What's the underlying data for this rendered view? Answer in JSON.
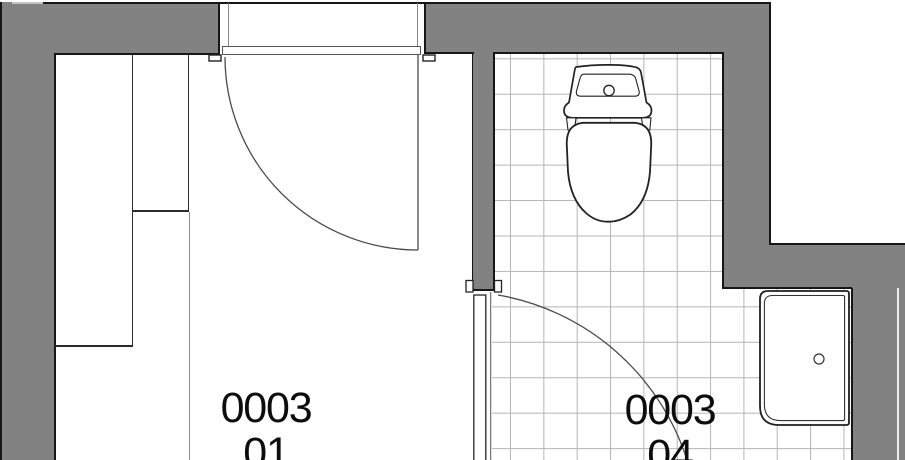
{
  "plan": {
    "type": "floor-plan",
    "rooms": [
      {
        "name": "room-0003-01",
        "number": "0003",
        "suffix": "01"
      },
      {
        "name": "room-0003-04",
        "number": "0003",
        "suffix": "04"
      }
    ],
    "fixtures": [
      {
        "name": "toilet",
        "location": "room-0003-04"
      },
      {
        "name": "shower-tray",
        "location": "room-0003-04"
      }
    ],
    "doors": [
      {
        "name": "door-room-01",
        "swing": "quarter-arc"
      },
      {
        "name": "door-room-04",
        "swing": "quarter-arc"
      }
    ],
    "colors": {
      "wall": "#828282",
      "outline": "#161616",
      "tile_line": "#b5b5b5",
      "floor": "#ffffff"
    }
  }
}
